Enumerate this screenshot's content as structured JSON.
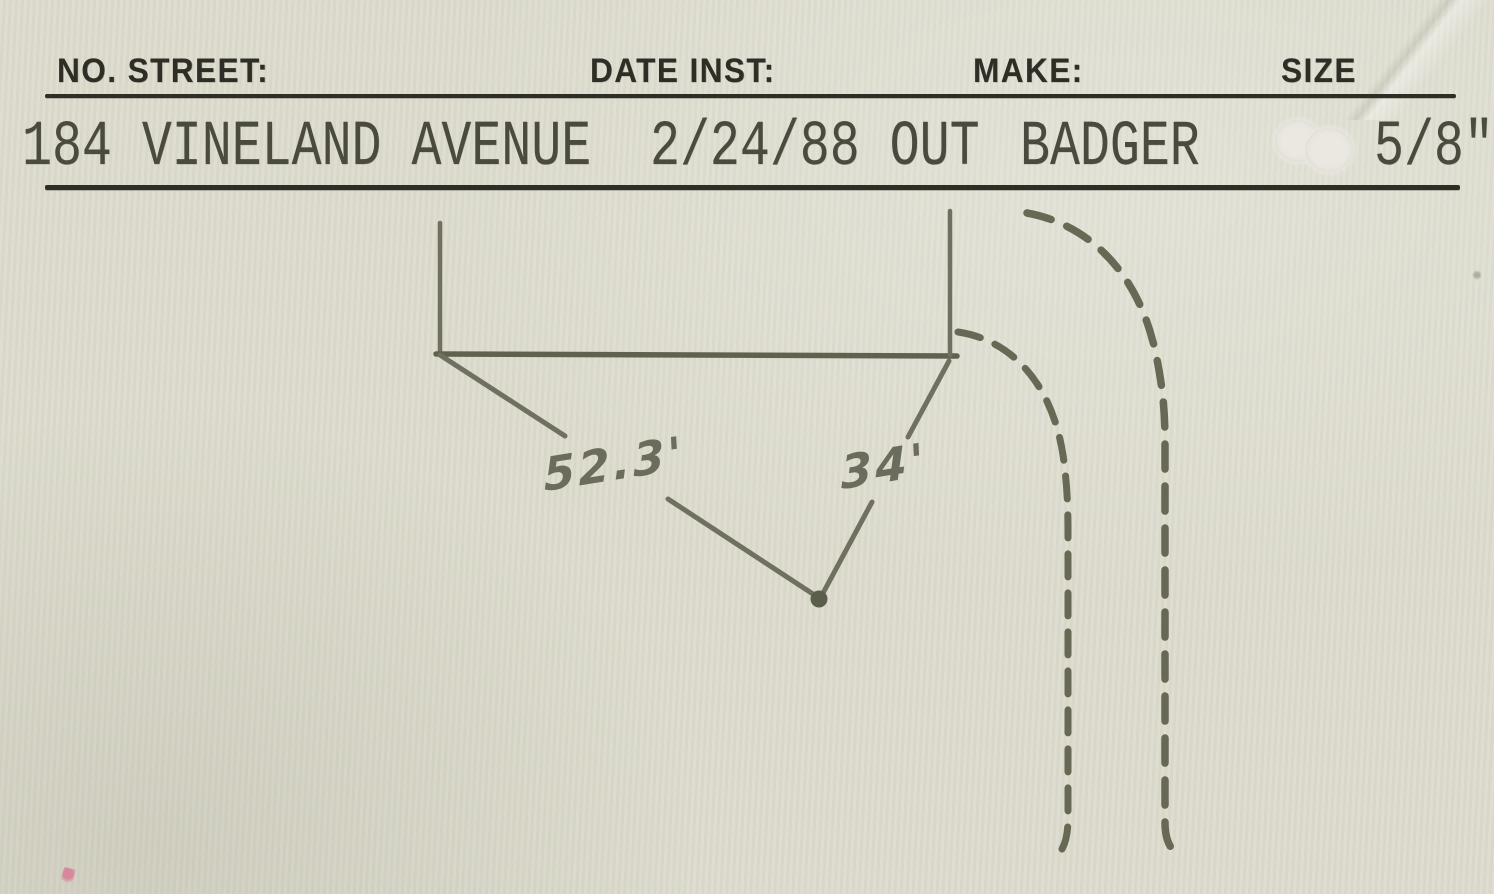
{
  "document_type": "water-meter-record-card",
  "header": {
    "labels": {
      "street": "NO. STREET:",
      "date": "DATE INST:",
      "make": "MAKE:",
      "size": "SIZE"
    }
  },
  "record": {
    "street": "184 VINELAND AVENUE",
    "date_inst": "2/24/88 OUT",
    "make": "BADGER",
    "size": "5/8\""
  },
  "sketch": {
    "description": "hand-drawn plot sketch: building outline with two dimension leader lines meeting at meter location dot, dashed curb corner lines",
    "dimension_left": "52.3'",
    "dimension_right": "34'"
  },
  "colors": {
    "paper": "#dcdbcd",
    "ink": "#2e2e26",
    "typed_ink": "#4a4a3e",
    "pencil": "#6f705f"
  }
}
